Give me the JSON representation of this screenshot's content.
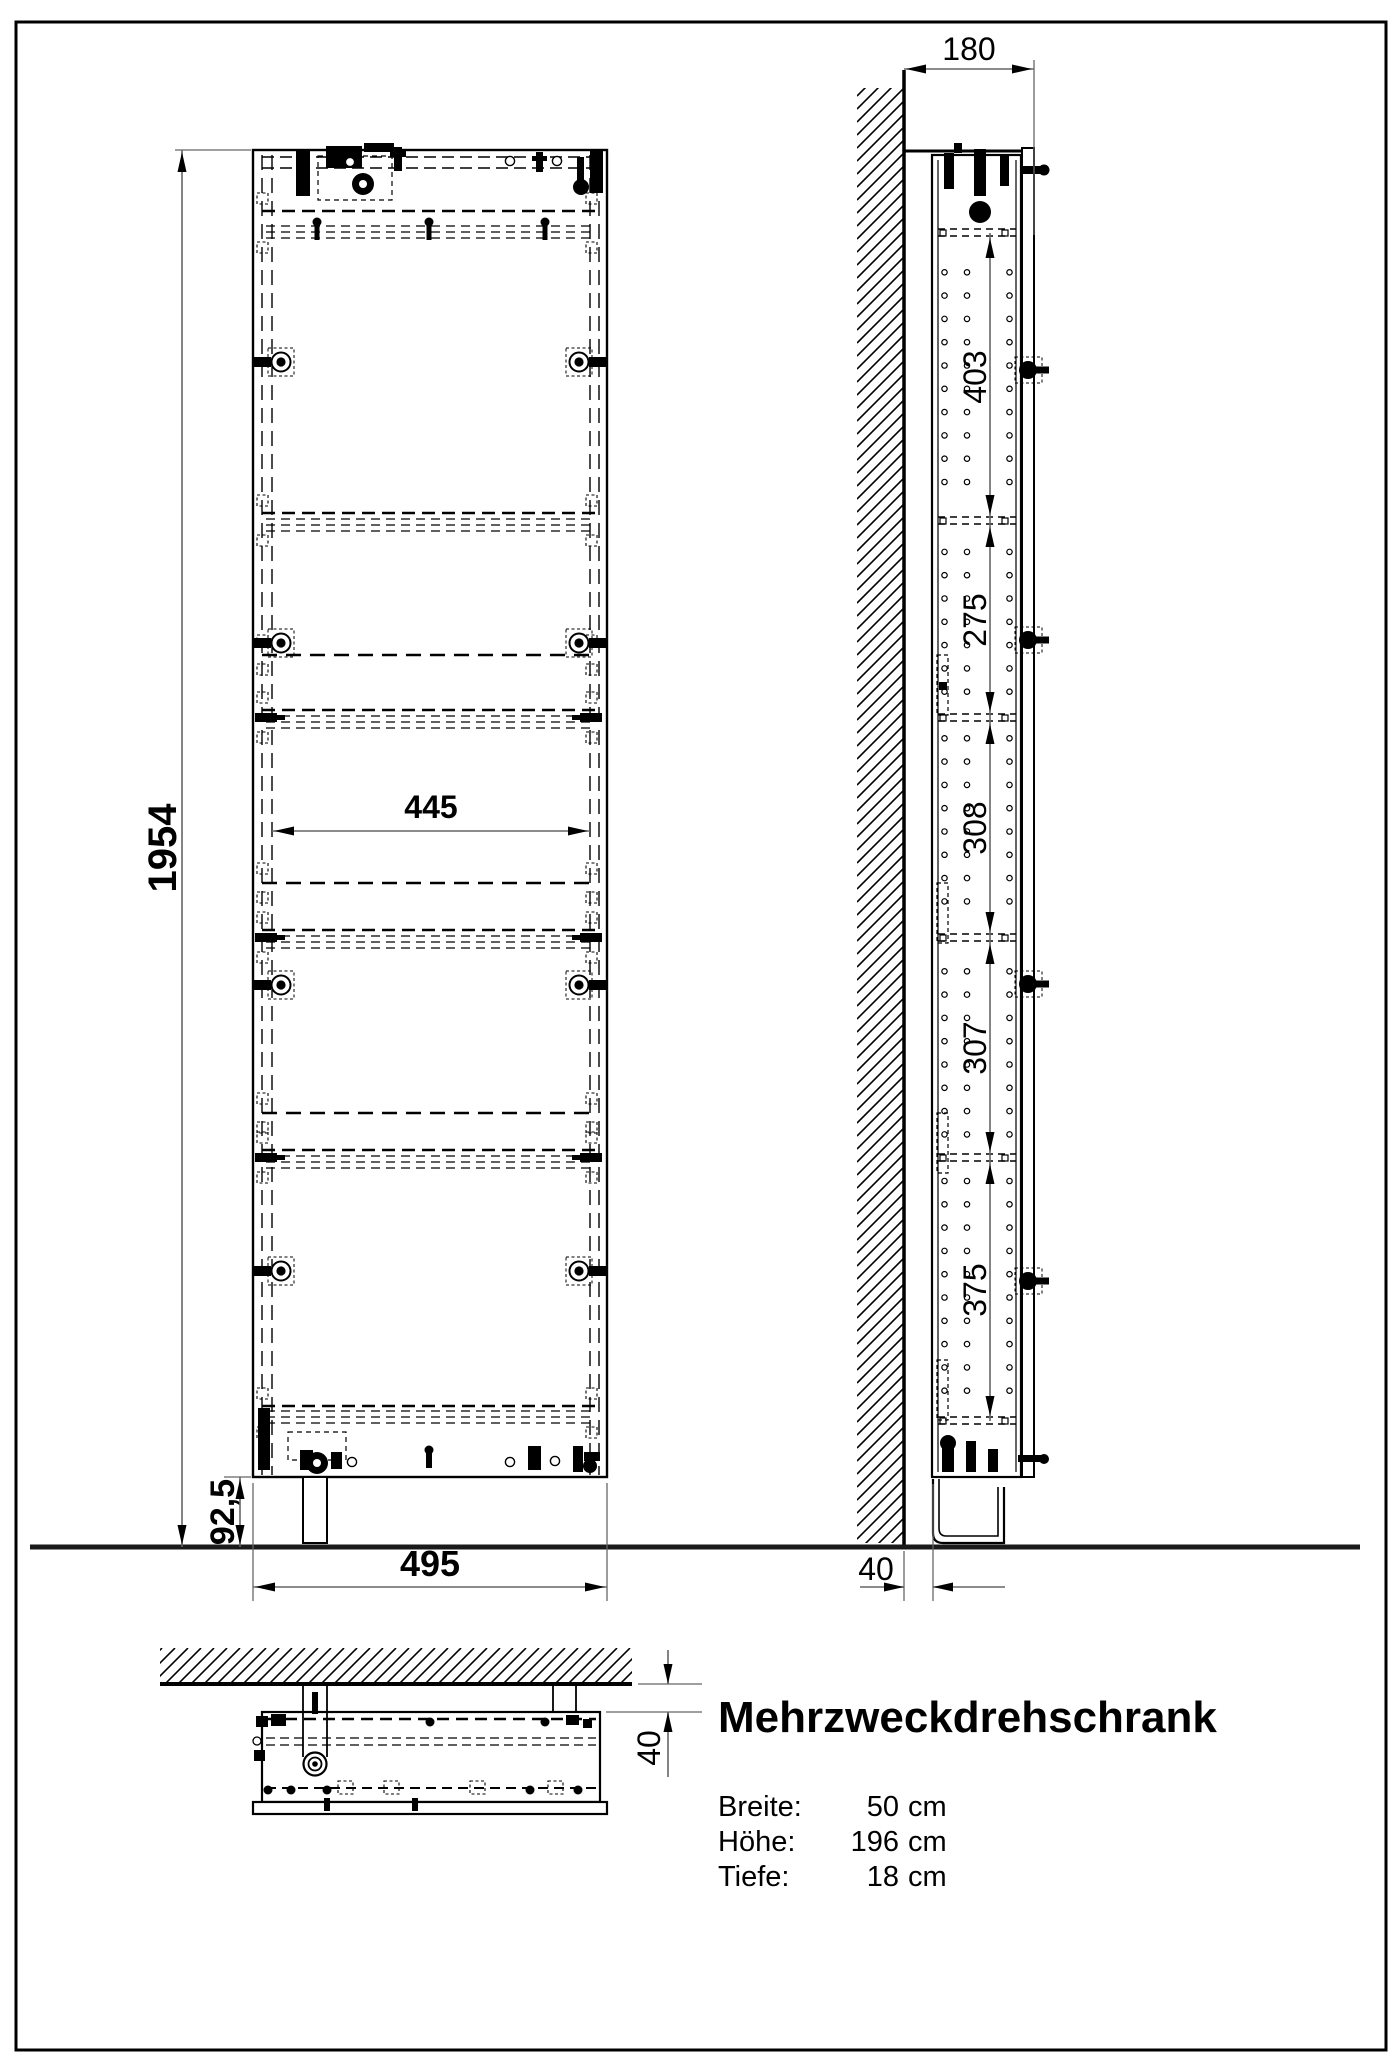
{
  "drawing": {
    "product_title": "Mehrzweckdrehschrank",
    "specs": [
      {
        "label": "Breite:",
        "value": "50",
        "unit": "cm"
      },
      {
        "label": "Höhe:",
        "value": "196",
        "unit": "cm"
      },
      {
        "label": "Tiefe:",
        "value": "18",
        "unit": "cm"
      }
    ],
    "dims": {
      "front": {
        "total_height": "1954",
        "inner_width": "445",
        "width": "495",
        "base_height": "92,5"
      },
      "side": {
        "depth": "180",
        "floor_gap": "40",
        "shelf_spacings": [
          "403",
          "275",
          "308",
          "307",
          "375"
        ]
      },
      "top": {
        "wall_gap": "40"
      }
    }
  }
}
